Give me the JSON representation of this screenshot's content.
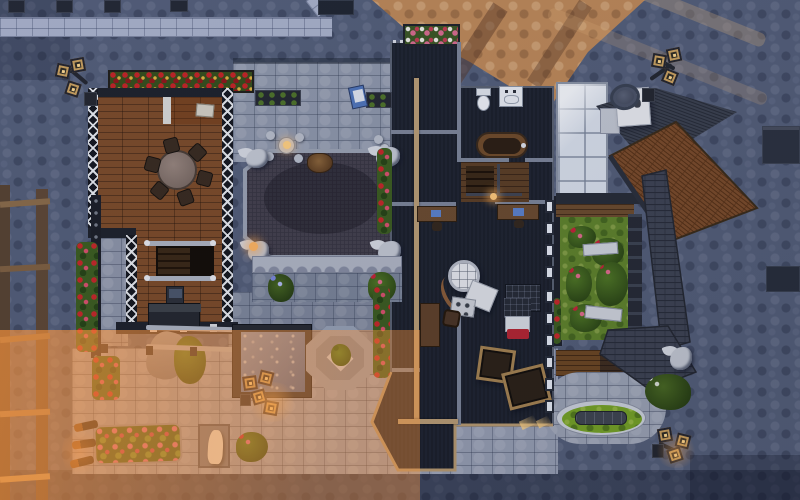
{
  "meta": {
    "title": "Top-down build-mode screenshot of a medieval-style residential lot",
    "view": "overhead",
    "canvas": {
      "width": 800,
      "height": 500
    }
  },
  "colors": {
    "street": "#535d76",
    "sidewalk": "#a9b1c8",
    "sunlit_cobble": "#bd8755",
    "patio_stone": "#979eb1",
    "courtyard_stone": "#7e8699",
    "terrace_stone": "#8e96a8",
    "wood_floor": "#7c4a26",
    "wood_floor_dark": "#5b3d22",
    "tudor_wall": "#191c24",
    "dark_house_floor": "#1a1e27",
    "wall_line": "#7c8496",
    "roof_beam_tan": "#b99c72",
    "chapel_roof": "#433f4a",
    "stone_trim": "#9aa1b0",
    "balcony_stone": "#b0b5c2",
    "grass": "#5f8228",
    "pond_grass": "#76a223",
    "pool_water": "#5f7fb4",
    "roof_brown": "#7a4a27",
    "roof_dark": "#3a3f4b",
    "gallery_roof": "#3d4250",
    "skylight_glass": "#d9dfe9",
    "deck_wood": "#6b451f",
    "rose_red": "#c42222",
    "flower_pink": "#d86a8c",
    "lantern_gold": "#caa05c",
    "glow_warm": "#ffb45e",
    "bench_stone": "#cfd3da",
    "statue_stone": "#ece6da",
    "gargoyle_stone": "#c3c7d0",
    "blanket_red": "#b52430",
    "crate_trim": "#a5824f",
    "warm_light": "rgba(255,150,60,0.40)"
  },
  "scene": {
    "ground": [
      "street-cobblestone",
      "sidewalk",
      "sunlit-plaza",
      "stone-patio",
      "courtyard-paving"
    ],
    "left_house": {
      "style": "tudor-half-timber",
      "objects": [
        "roof-flower-box-red",
        "round-dining-table",
        "dining-chairs-x6",
        "side-room-table",
        "staircase",
        "pedestal-screen",
        "tv-sideboard",
        "steel-beam",
        "rose-trellis",
        "pergola",
        "swimming-pool",
        "garden-slide",
        "ivy-bush"
      ]
    },
    "courtyard": {
      "objects": [
        "cafe-table-set",
        "window-planters-x2",
        "easel",
        "chapel-octagon-roof",
        "roof-crest",
        "gargoyle-statues-x4",
        "scalloped-balcony",
        "planter-blue-flowers",
        "planter-red-flowers",
        "octagon-fountain-planter"
      ]
    },
    "dark_house": {
      "objects": [
        "parapet-flower-box",
        "parapet-studs",
        "toilet",
        "sink-vanity",
        "wooden-bathtub",
        "stairwell",
        "study-desk-x2",
        "orrery-machine",
        "pallet-rack",
        "writing-desk",
        "armchair",
        "single-bed",
        "storage-crates-x2",
        "wall-windows-x10",
        "ridge-beam"
      ]
    },
    "right_wing": {
      "objects": [
        "glass-skylight",
        "chimney",
        "brown-hip-roof",
        "dark-hip-roof",
        "gallery-roof",
        "rose-garden",
        "stone-benches-x2",
        "garden-fence",
        "wooden-deck",
        "oval-pond",
        "stone-trough",
        "white-flower-bush",
        "roof-gargoyle"
      ]
    },
    "street_objects": [
      "triple-lantern-lamp-x4",
      "wall-torches-x3",
      "manhole-cover",
      "garden-statue-in-niche",
      "flower-bed",
      "rose-bush",
      "scaffold-ladder",
      "fence-posts",
      "wall-blocks"
    ]
  }
}
